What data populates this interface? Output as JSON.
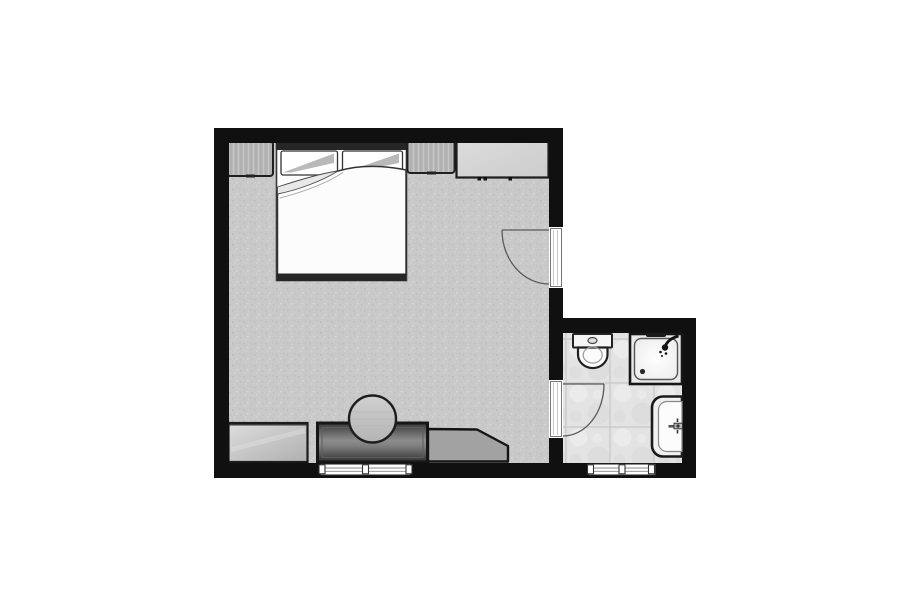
{
  "image": {
    "type": "architectural-floor-plan",
    "style": "black-and-white top-down plan of a bedroom with en-suite bathroom",
    "background": "#ffffff"
  },
  "colors": {
    "wall": "#101010",
    "bedroom_floor": "#c9c9c9",
    "bathroom_floor": "#e3e3e3",
    "fixture_white": "#fafafa",
    "furniture_light": "#d6d6d6",
    "furniture_mid": "#a2a2a2",
    "furniture_dark": "#3d3d3d",
    "outline": "#1a1a1a",
    "door_arc": "#5a5a5a"
  },
  "rooms": [
    {
      "name": "bedroom",
      "position": "left",
      "floor": "speckled gray carpet"
    },
    {
      "name": "bathroom",
      "position": "bottom-right",
      "floor": "light tile with grid lines"
    }
  ],
  "furniture": [
    {
      "name": "double-bed",
      "room": "bedroom",
      "position": "top-left",
      "details": "headboard on top wall, two pillows, duvet with folded-back corner, dark footboard"
    },
    {
      "name": "nightstand-left",
      "room": "bedroom",
      "position": "top wall, left of bed",
      "details": "wood-grain texture"
    },
    {
      "name": "nightstand-right",
      "room": "bedroom",
      "position": "top wall, right of bed",
      "details": "wood-grain texture"
    },
    {
      "name": "wall-cabinet",
      "room": "bedroom",
      "position": "top wall, right corner",
      "details": "light gray, small handle marks on front"
    },
    {
      "name": "dresser",
      "room": "bedroom",
      "position": "bottom wall, left",
      "details": "light gray sideboard"
    },
    {
      "name": "desk",
      "room": "bedroom",
      "position": "bottom wall, center",
      "details": "dark gray top"
    },
    {
      "name": "stool",
      "room": "bedroom",
      "position": "at desk, round seat",
      "details": "circular, overlaps desk"
    },
    {
      "name": "lounge-chair",
      "room": "bedroom",
      "position": "bottom wall, right of desk",
      "details": "gray shape with clipped corner"
    }
  ],
  "fixtures": [
    {
      "name": "toilet",
      "room": "bathroom",
      "position": "top-left",
      "details": "tank with flush button against top wall"
    },
    {
      "name": "shower",
      "room": "bathroom",
      "position": "top-right",
      "details": "square tray, head at top-right, drain bottom-left, grab bar on top"
    },
    {
      "name": "sink",
      "room": "bathroom",
      "position": "bottom-right",
      "details": "rounded basin on right wall with wall tap"
    }
  ],
  "doors": [
    {
      "name": "bedroom-entry-door",
      "wall": "right wall of bedroom",
      "swing": "opens into bedroom, hinge at top of opening"
    },
    {
      "name": "bathroom-door",
      "wall": "wall between bedroom and bathroom",
      "swing": "opens into bathroom, hinge at top of opening"
    }
  ],
  "windows": [
    {
      "name": "bedroom-window",
      "wall": "bottom wall of bedroom, below desk",
      "details": "sill with three mullion posts"
    },
    {
      "name": "bathroom-window",
      "wall": "bottom wall of bathroom",
      "details": "sill with three mullion posts"
    }
  ]
}
